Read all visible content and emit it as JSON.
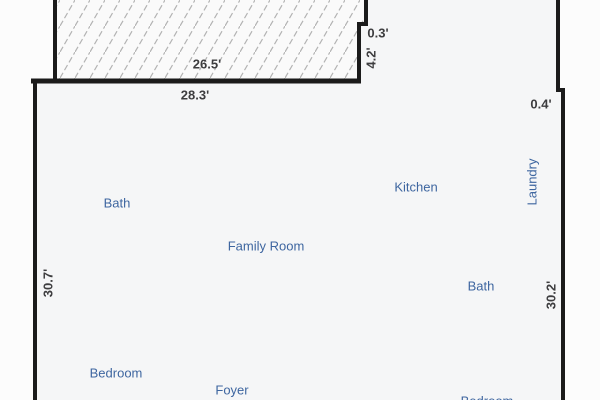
{
  "floor_plan": {
    "rooms": [
      {
        "id": "bath-upper",
        "label": "Bath"
      },
      {
        "id": "kitchen",
        "label": "Kitchen"
      },
      {
        "id": "family-room",
        "label": "Family Room"
      },
      {
        "id": "laundry",
        "label": "Laundry"
      },
      {
        "id": "bath-lower",
        "label": "Bath"
      },
      {
        "id": "bedroom",
        "label": "Bedroom"
      },
      {
        "id": "foyer",
        "label": "Foyer"
      },
      {
        "id": "bedroom-partial",
        "label": "Bedroom"
      }
    ],
    "dimensions": [
      {
        "id": "top-garage-width",
        "label": "26.5'"
      },
      {
        "id": "top-wall-width",
        "label": "28.3'"
      },
      {
        "id": "notch-width",
        "label": "0.3'"
      },
      {
        "id": "notch-height",
        "label": "4.2'"
      },
      {
        "id": "right-step-width",
        "label": "0.4'"
      },
      {
        "id": "left-wall-height",
        "label": "30.7'"
      },
      {
        "id": "right-wall-height",
        "label": "30.2'"
      }
    ],
    "colors": {
      "room_label": "#3e66a0",
      "dimension_label": "#3d3d3f",
      "wall": "#1b1b1b",
      "hatch_line": "#b3b3b3",
      "floor": "#f5f6f7",
      "background": "#fcfcfc"
    }
  }
}
